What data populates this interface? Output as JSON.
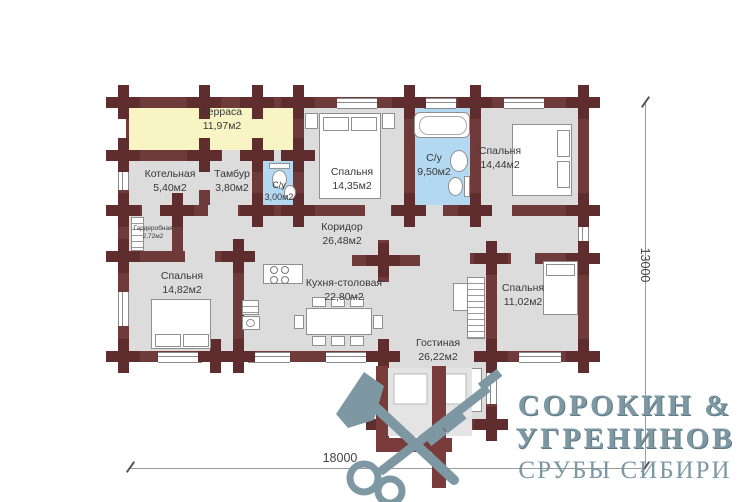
{
  "plan": {
    "rooms": [
      {
        "name": "Терраса",
        "area": "11,97м2"
      },
      {
        "name": "Котельная",
        "area": "5,40м2"
      },
      {
        "name": "Тамбур",
        "area": "3,80м2"
      },
      {
        "name": "С/у",
        "area": "3,00м2"
      },
      {
        "name": "Спальня",
        "area": "14,35м2"
      },
      {
        "name": "С/у",
        "area": "9,50м2"
      },
      {
        "name": "Спальня",
        "area": "14,44м2"
      },
      {
        "name": "Гардеробная",
        "area": "2,72м2"
      },
      {
        "name": "Коридор",
        "area": "26,48м2"
      },
      {
        "name": "Спальня",
        "area": "14,82м2"
      },
      {
        "name": "Кухня-столовая",
        "area": "22,80м2"
      },
      {
        "name": "Гостиная",
        "area": "26,22м2"
      },
      {
        "name": "Спальня",
        "area": "11,02м2"
      }
    ],
    "dimensions": {
      "width": "18000",
      "height": "13000"
    },
    "colors": {
      "wall": "#6e3a3a",
      "log_end": "#5f2d2d",
      "floor": "#dcdcdc",
      "terrace": "#f8f4c3",
      "wet_room": "#b3d8f2"
    }
  },
  "logo": {
    "line1": "СОРОКИН &",
    "line2": "УГРЕНИНОВ",
    "line3": "СРУБЫ СИБИРИ",
    "color": "#7d98a3"
  }
}
